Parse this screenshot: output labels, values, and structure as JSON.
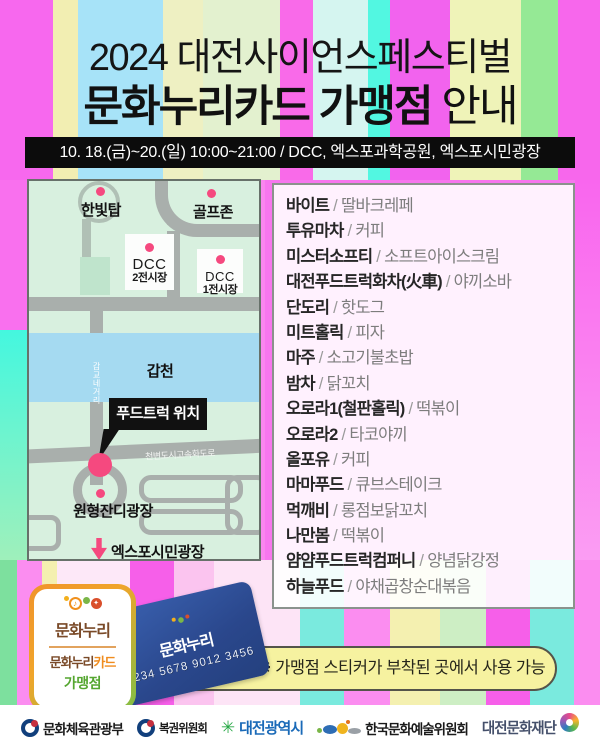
{
  "title": {
    "line1": "2024 대전사이언스페스티벌",
    "line2_strong": "문화누리카드 가맹점",
    "line2_tail": " 안내"
  },
  "info_bar": "10. 18.(금)~20.(일) 10:00~21:00 / DCC, 엑스포과학공원, 엑스포시민광장",
  "map": {
    "hanbit_tower": "한빛탑",
    "golf_zone": "골프존",
    "dcc2_name": "DCC",
    "dcc2_sub": "2전시장",
    "dcc1_name": "DCC",
    "dcc1_sub": "1전시장",
    "river": "갑천",
    "vertical_road": "갑교네거리",
    "expressway": "천변도시고속화도로",
    "food_truck_callout": "푸드트럭 위치",
    "round_plaza": "원형잔디광장",
    "citizens_plaza": "엑스포시민광장"
  },
  "vendor_separator": "/",
  "vendors": [
    {
      "name": "바이트",
      "menu": "딸바크레페"
    },
    {
      "name": "투유마차",
      "menu": "커피"
    },
    {
      "name": "미스터소프티",
      "menu": "소프트아이스크림"
    },
    {
      "name": "대전푸드트럭화차(火車)",
      "menu": "야끼소바"
    },
    {
      "name": "단도리",
      "menu": "핫도그"
    },
    {
      "name": "미트홀릭",
      "menu": "피자"
    },
    {
      "name": "마주",
      "menu": "소고기불초밥"
    },
    {
      "name": "밤차",
      "menu": "닭꼬치"
    },
    {
      "name": "오로라1(철판홀릭)",
      "menu": "떡볶이"
    },
    {
      "name": "오로라2",
      "menu": "타코야끼"
    },
    {
      "name": "올포유",
      "menu": "커피"
    },
    {
      "name": "마마푸드",
      "menu": "큐브스테이크"
    },
    {
      "name": "먹깨비",
      "menu": "롱점보닭꼬치"
    },
    {
      "name": "나만봄",
      "menu": "떡볶이"
    },
    {
      "name": "얌얌푸드트럭컴퍼니",
      "menu": "양념닭강정"
    },
    {
      "name": "하늘푸드",
      "menu": "야채곱창순대볶음"
    }
  ],
  "sticker": {
    "brand": "문화누리",
    "card_prefix": "문화누리",
    "card_suffix": "카드",
    "member": "가맹점",
    "music_note": "♪",
    "sparkle": "✦"
  },
  "card": {
    "brand": "문화누리",
    "number": "1234 5678 9012 3456"
  },
  "notice": "※ 가맹점 스티커가 부착된 곳에서 사용 가능",
  "footer": {
    "org1": "문화체육관광부",
    "org2": "복권위원회",
    "org3": "대전광역시",
    "org3_icon": "✳",
    "org4": "한국문화예술위원회",
    "org5": "대전문화재단"
  },
  "colors": {
    "accent_pink": "#F5497F",
    "card_blue": "#2C4C94",
    "notice_yellow": "#F6F2A0",
    "map_green": "#D8F0DF",
    "river_blue": "#A5DAF1",
    "road_gray": "#A9AFAC"
  }
}
